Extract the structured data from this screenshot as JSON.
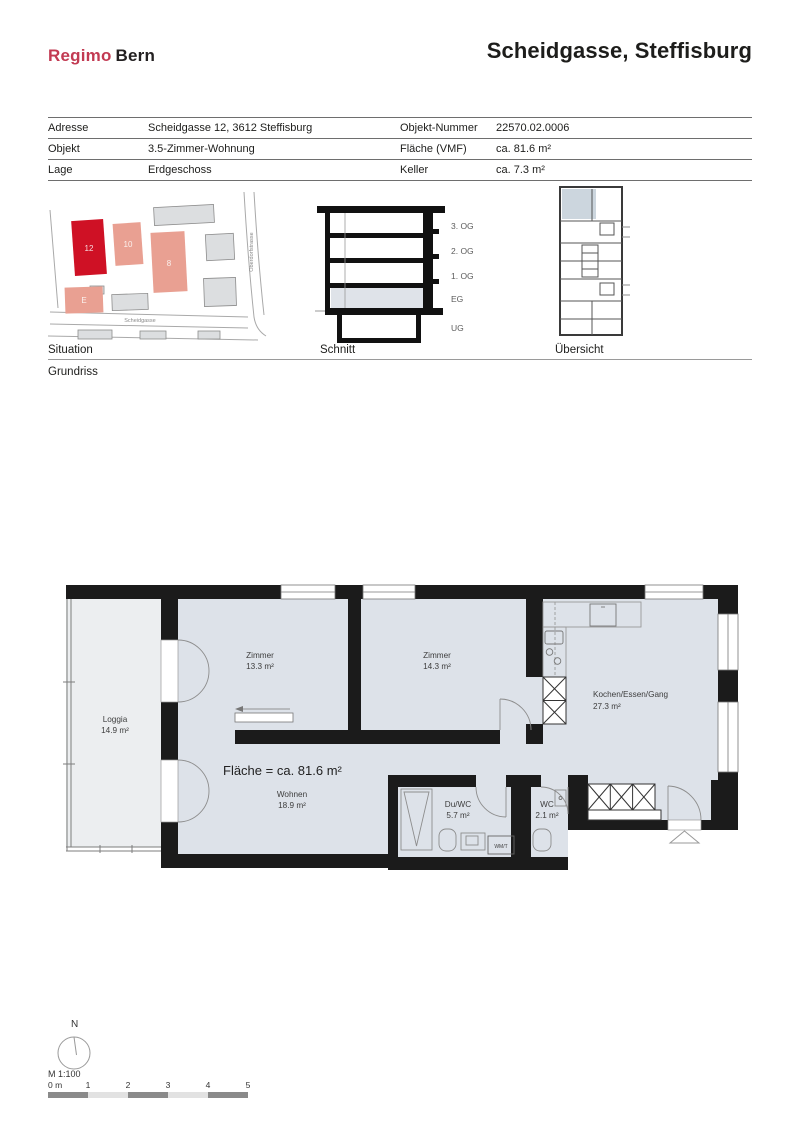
{
  "header": {
    "logo_primary": "Regimo",
    "logo_secondary": "Bern",
    "title": "Scheidgasse, Steffisburg"
  },
  "info_table": {
    "rows": [
      {
        "label_left": "Adresse",
        "value_left": "Scheidgasse 12, 3612 Steffisburg",
        "label_right": "Objekt-Nummer",
        "value_right": "22570.02.0006"
      },
      {
        "label_left": "Objekt",
        "value_left": "3.5-Zimmer-Wohnung",
        "label_right": "Fläche (VMF)",
        "value_right": "ca. 81.6 m²"
      },
      {
        "label_left": "Lage",
        "value_left": "Erdgeschoss",
        "label_right": "Keller",
        "value_right": "ca. 7.3 m²"
      }
    ]
  },
  "thumbnails": {
    "situation": {
      "label": "Situation",
      "buildings": [
        "12",
        "10",
        "8",
        "E"
      ],
      "streets": [
        "Scheidgasse",
        "Oberdorfstrasse"
      ],
      "highlight_color": "#cf1125",
      "neighbor_color": "#e9a092"
    },
    "schnitt": {
      "label": "Schnitt",
      "floors": [
        "3. OG",
        "2. OG",
        "1. OG",
        "EG",
        "UG"
      ],
      "highlighted_floor": "EG"
    },
    "uebersicht": {
      "label": "Übersicht"
    }
  },
  "section_label": "Grundriss",
  "floorplan": {
    "total_area_label": "Fläche = ca. 81.6 m²",
    "rooms": [
      {
        "name": "Zimmer",
        "area": "13.3 m²"
      },
      {
        "name": "Zimmer",
        "area": "14.3 m²"
      },
      {
        "name": "Kochen/Essen/Gang",
        "area": "27.3 m²"
      },
      {
        "name": "Loggia",
        "area": "14.9 m²"
      },
      {
        "name": "Wohnen",
        "area": "18.9 m²"
      },
      {
        "name": "Du/WC",
        "area": "5.7 m²"
      },
      {
        "name": "WC",
        "area": "2.1 m²"
      }
    ],
    "appliance_label": "WM/T",
    "colors": {
      "interior_fill": "#dde2e9",
      "loggia_fill": "#eceef0",
      "wall": "#1b1b1b"
    }
  },
  "footer": {
    "north_label": "N",
    "scale_label": "M 1:100",
    "scale_ticks": [
      "0 m",
      "1",
      "2",
      "3",
      "4",
      "5"
    ]
  }
}
